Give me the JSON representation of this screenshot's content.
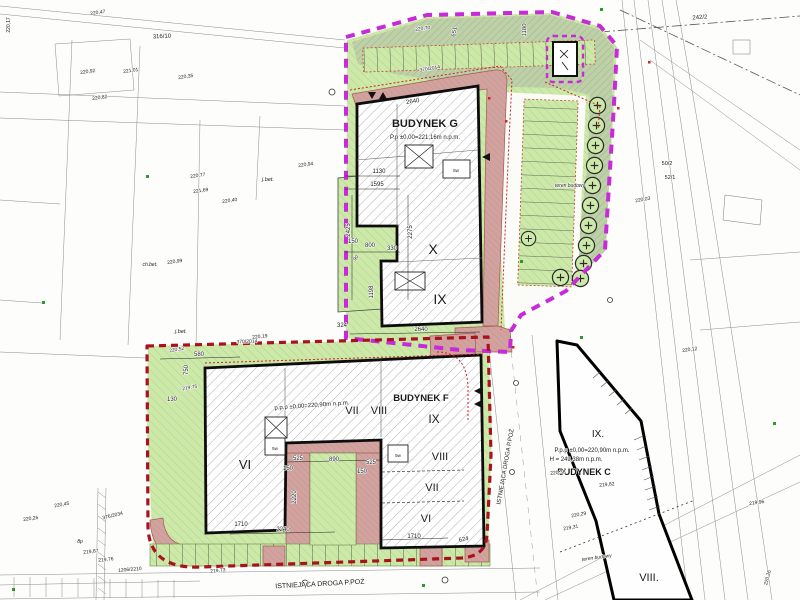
{
  "plan": {
    "type_note": "site development plan drawing",
    "colors": {
      "boundary_upper_site": "#c62ad9",
      "boundary_lower_site": "#a8121f",
      "greenery": "#cde9a9",
      "greenery_dark": "#bed0a8",
      "fire_road_surface": "#d2a29e",
      "building_outline": "#0d0d0d",
      "survey_lines": "#8a8a8a"
    },
    "buildings": {
      "g": {
        "name": "BUDYNEK G",
        "level": "P.p ±0,00=221,16m n.p.m.",
        "storeys": [
          "X",
          "IX"
        ]
      },
      "f": {
        "name": "BUDYNEK F",
        "level": "p.p.p ±0,00=220,90m n.p.m.",
        "storeys": [
          "IX",
          "VIII",
          "VII",
          "VI"
        ]
      },
      "c": {
        "name": "BUDYNEK C",
        "level": "P.p.p ±0,00=220,90m n.p.m.",
        "height": "H = 249,38m n.p.m.",
        "storeys": [
          "IX.",
          "VIII."
        ]
      }
    },
    "roads": {
      "existing_fire_road": "ISTNIEJĄCA DROGA P.POŻ"
    }
  },
  "annotations": [
    {
      "n": "building-g-label",
      "x": 425,
      "y": 127,
      "t": "BUDYNEK G",
      "s": 11,
      "b": true
    },
    {
      "n": "building-g-level",
      "x": 425,
      "y": 139,
      "t": "P.p ±0,00=221,16m n.p.m.",
      "s": 6
    },
    {
      "n": "building-g-floor-x",
      "x": 433,
      "y": 254,
      "t": "X",
      "s": 14
    },
    {
      "n": "building-g-floor-ix",
      "x": 440,
      "y": 304,
      "t": "IX",
      "s": 14
    },
    {
      "n": "building-f-label",
      "x": 421,
      "y": 401,
      "t": "BUDYNEK F",
      "s": 9.5,
      "b": true
    },
    {
      "n": "building-f-floor-ix",
      "x": 434,
      "y": 423,
      "t": "IX",
      "s": 12
    },
    {
      "n": "building-f-level",
      "x": 312,
      "y": 407,
      "t": "p.p.p ±0,00=220,90m n.p.m.",
      "s": 6,
      "r": -4
    },
    {
      "n": "building-f-floor-vii-top",
      "x": 352,
      "y": 414,
      "t": "VII",
      "s": 11
    },
    {
      "n": "building-f-floor-viii-top",
      "x": 379,
      "y": 414,
      "t": "VIII",
      "s": 11
    },
    {
      "n": "building-f-floor-viii",
      "x": 440,
      "y": 460,
      "t": "VIII",
      "s": 11
    },
    {
      "n": "building-f-floor-vii",
      "x": 432,
      "y": 491,
      "t": "VII",
      "s": 11
    },
    {
      "n": "building-f-floor-vi",
      "x": 426,
      "y": 522,
      "t": "VI",
      "s": 11
    },
    {
      "n": "building-f-floor-vi-left",
      "x": 245,
      "y": 469,
      "t": "VI",
      "s": 13
    },
    {
      "n": "building-c-floor-ix",
      "x": 598,
      "y": 437,
      "t": "IX.",
      "s": 10
    },
    {
      "n": "building-c-level",
      "x": 592,
      "y": 452,
      "t": "P.p.p ±0,00=220,90m n.p.m.",
      "s": 6
    },
    {
      "n": "building-c-height",
      "x": 576,
      "y": 461,
      "t": "H = 249,38m n.p.m.",
      "s": 6
    },
    {
      "n": "building-c-label",
      "x": 584,
      "y": 475,
      "t": "BUDYNEK C",
      "s": 9,
      "b": true
    },
    {
      "n": "building-c-floor-viii",
      "x": 649,
      "y": 581,
      "t": "VIII.",
      "s": 11
    },
    {
      "n": "fire-road-label-bottom",
      "x": 320,
      "y": 586,
      "t": "ISTNIEJĄCA DROGA P.POŻ",
      "s": 7,
      "r": -3
    },
    {
      "n": "fire-road-label-right",
      "x": 507,
      "y": 467,
      "t": "ISTNIEJĄCA DROGA P.POŻ",
      "s": 6,
      "r": -80
    },
    {
      "n": "teren-budowy-upper",
      "x": 570,
      "y": 187,
      "t": "teren budowy",
      "s": 5,
      "i": true
    },
    {
      "n": "teren-budowy-lower",
      "x": 597,
      "y": 559,
      "t": "teren budowy",
      "s": 5,
      "i": true,
      "r": -8
    },
    {
      "n": "parcel-number",
      "x": 700,
      "y": 19,
      "t": "242/2",
      "s": 6,
      "r": -4
    },
    {
      "n": "parcel-number",
      "x": 162,
      "y": 38,
      "t": "316/10",
      "s": 6,
      "r": -3
    },
    {
      "n": "parcel-number",
      "x": 667,
      "y": 165,
      "t": "50/2",
      "s": 5.5
    },
    {
      "n": "parcel-number",
      "x": 670,
      "y": 179,
      "t": "52/1",
      "s": 5.5
    },
    {
      "n": "parcel-number",
      "x": 247,
      "y": 343,
      "t": "370/2014",
      "s": 5,
      "r": -2
    },
    {
      "n": "parcel-number",
      "x": 430,
      "y": 70,
      "t": "370/2014",
      "s": 5,
      "r": -9
    },
    {
      "n": "parcel-number",
      "x": 113,
      "y": 517,
      "t": "376/2034",
      "s": 5,
      "r": -14
    },
    {
      "n": "parcel-number",
      "x": 130,
      "y": 571,
      "t": "1206/2210",
      "s": 5,
      "r": -5
    },
    {
      "n": "surface-note",
      "x": 268,
      "y": 181,
      "t": "j.bet.",
      "s": 5.5,
      "i": true
    },
    {
      "n": "surface-note",
      "x": 181,
      "y": 333,
      "t": "j.bet.",
      "s": 5.5,
      "i": true
    },
    {
      "n": "surface-note",
      "x": 150,
      "y": 266,
      "t": "ch.bet.",
      "s": 5,
      "i": true
    },
    {
      "n": "surface-note",
      "x": 80,
      "y": 543,
      "t": "8p",
      "s": 5,
      "i": true
    },
    {
      "n": "spot-height",
      "x": 98,
      "y": 14,
      "t": "220,47",
      "s": 5,
      "r": -8
    },
    {
      "n": "spot-height",
      "x": 88,
      "y": 73,
      "t": "220,92",
      "s": 5,
      "r": -8
    },
    {
      "n": "spot-height",
      "x": 131,
      "y": 72,
      "t": "221,01",
      "s": 5,
      "r": -8
    },
    {
      "n": "spot-height",
      "x": 186,
      "y": 78,
      "t": "220,35",
      "s": 5,
      "r": -8
    },
    {
      "n": "spot-height",
      "x": 100,
      "y": 99,
      "t": "220,82",
      "s": 5,
      "r": -8
    },
    {
      "n": "spot-height",
      "x": 198,
      "y": 177,
      "t": "220,77",
      "s": 5,
      "r": -8
    },
    {
      "n": "spot-height",
      "x": 201,
      "y": 192,
      "t": "221,69",
      "s": 5,
      "r": -8
    },
    {
      "n": "spot-height",
      "x": 230,
      "y": 202,
      "t": "220,40",
      "s": 5,
      "r": -8
    },
    {
      "n": "spot-height",
      "x": 306,
      "y": 166,
      "t": "220,94",
      "s": 5,
      "r": -8
    },
    {
      "n": "spot-height",
      "x": 175,
      "y": 263,
      "t": "220,99",
      "s": 5,
      "r": -8
    },
    {
      "n": "spot-height",
      "x": 190,
      "y": 389,
      "t": "219,75",
      "s": 5,
      "r": -10
    },
    {
      "n": "spot-height",
      "x": 177,
      "y": 351,
      "t": "220,52",
      "s": 5,
      "r": -10
    },
    {
      "n": "spot-height",
      "x": 260,
      "y": 338,
      "t": "220,19",
      "s": 5,
      "r": -6
    },
    {
      "n": "spot-height",
      "x": 218,
      "y": 572,
      "t": "219,73",
      "s": 5,
      "r": -6
    },
    {
      "n": "spot-height",
      "x": 579,
      "y": 516,
      "t": "220,29",
      "s": 5,
      "r": -10
    },
    {
      "n": "spot-height",
      "x": 571,
      "y": 529,
      "t": "219,31",
      "s": 5,
      "r": -10
    },
    {
      "n": "spot-height",
      "x": 757,
      "y": 504,
      "t": "219,96",
      "s": 5,
      "r": -8
    },
    {
      "n": "spot-height",
      "x": 769,
      "y": 578,
      "t": "220,26",
      "s": 5,
      "r": -75
    },
    {
      "n": "spot-height",
      "x": 607,
      "y": 486,
      "t": "219,82",
      "s": 5,
      "r": -6
    },
    {
      "n": "spot-height",
      "x": 558,
      "y": 474,
      "t": "220,38",
      "s": 5,
      "r": -6
    },
    {
      "n": "spot-height",
      "x": 62,
      "y": 506,
      "t": "220,45",
      "s": 5,
      "r": -10
    },
    {
      "n": "spot-height",
      "x": 31,
      "y": 520,
      "t": "220,26",
      "s": 5,
      "r": -8
    },
    {
      "n": "spot-height",
      "x": 91,
      "y": 553,
      "t": "219,87",
      "s": 5,
      "r": -6
    },
    {
      "n": "spot-height",
      "x": 106,
      "y": 561,
      "t": "219,76",
      "s": 5,
      "r": -6
    },
    {
      "n": "spot-height",
      "x": 643,
      "y": 201,
      "t": "220,03",
      "s": 5,
      "r": -10
    },
    {
      "n": "spot-height",
      "x": 690,
      "y": 351,
      "t": "220,12",
      "s": 5,
      "r": -8
    },
    {
      "n": "spot-height",
      "x": 423,
      "y": 30,
      "t": "220,70",
      "s": 5,
      "r": -8
    },
    {
      "n": "spot-height",
      "x": 10,
      "y": 25,
      "t": "220,17",
      "s": 5,
      "r": -90
    },
    {
      "n": "dimension-label",
      "x": 413,
      "y": 103,
      "t": "2640",
      "s": 6,
      "r": -9
    },
    {
      "n": "dimension-label",
      "x": 421,
      "y": 331,
      "t": "2640",
      "s": 6
    },
    {
      "n": "dimension-label",
      "x": 379,
      "y": 173,
      "t": "1130",
      "s": 6
    },
    {
      "n": "dimension-label",
      "x": 377,
      "y": 186,
      "t": "1595",
      "s": 6
    },
    {
      "n": "dimension-label",
      "x": 412,
      "y": 232,
      "t": "2275",
      "s": 6,
      "r": -90
    },
    {
      "n": "dimension-label",
      "x": 350,
      "y": 230,
      "t": "2425",
      "s": 6,
      "r": -90
    },
    {
      "n": "dimension-label",
      "x": 353,
      "y": 243,
      "t": "150",
      "s": 6
    },
    {
      "n": "dimension-label",
      "x": 370,
      "y": 247,
      "t": "800",
      "s": 6
    },
    {
      "n": "dimension-label",
      "x": 392,
      "y": 250,
      "t": "330",
      "s": 6
    },
    {
      "n": "dimension-label",
      "x": 373,
      "y": 292,
      "t": "1198",
      "s": 6,
      "r": -90
    },
    {
      "n": "dimension-label",
      "x": 342,
      "y": 327,
      "t": "324",
      "s": 6
    },
    {
      "n": "dimension-label",
      "x": 199,
      "y": 356,
      "t": "580",
      "s": 6
    },
    {
      "n": "dimension-label",
      "x": 188,
      "y": 370,
      "t": "750",
      "s": 6,
      "r": -90
    },
    {
      "n": "dimension-label",
      "x": 172,
      "y": 401,
      "t": "130",
      "s": 6
    },
    {
      "n": "dimension-label",
      "x": 298,
      "y": 460,
      "t": "525",
      "s": 6
    },
    {
      "n": "dimension-label",
      "x": 334,
      "y": 461,
      "t": "890",
      "s": 6
    },
    {
      "n": "dimension-label",
      "x": 371,
      "y": 464,
      "t": "525",
      "s": 6
    },
    {
      "n": "dimension-label",
      "x": 288,
      "y": 470,
      "t": "150",
      "s": 6
    },
    {
      "n": "dimension-label",
      "x": 362,
      "y": 473,
      "t": "150",
      "s": 6
    },
    {
      "n": "dimension-label",
      "x": 296,
      "y": 497,
      "t": "2220",
      "s": 6,
      "r": -90
    },
    {
      "n": "dimension-label",
      "x": 283,
      "y": 531,
      "t": "2240",
      "s": 6
    },
    {
      "n": "dimension-label",
      "x": 414,
      "y": 538,
      "t": "1710",
      "s": 6
    },
    {
      "n": "dimension-label",
      "x": 464,
      "y": 541,
      "t": "624",
      "s": 6,
      "r": -12
    },
    {
      "n": "dimension-label",
      "x": 241,
      "y": 526,
      "t": "1710",
      "s": 6
    },
    {
      "n": "dimension-label",
      "x": 456,
      "y": 32,
      "t": "651",
      "s": 6,
      "r": -80
    },
    {
      "n": "dimension-label",
      "x": 526,
      "y": 30,
      "t": "1180",
      "s": 6,
      "r": -87
    },
    {
      "n": "dimension-label",
      "x": 357,
      "y": 259,
      "t": "90",
      "s": 5,
      "r": -50
    },
    {
      "n": "vent-shaft-label",
      "x": 456,
      "y": 172,
      "t": "5w",
      "s": 4.5
    },
    {
      "n": "vent-shaft-label",
      "x": 275,
      "y": 450,
      "t": "5w",
      "s": 4.5
    },
    {
      "n": "vent-shaft-label",
      "x": 398,
      "y": 457,
      "t": "5w",
      "s": 4.5
    }
  ]
}
